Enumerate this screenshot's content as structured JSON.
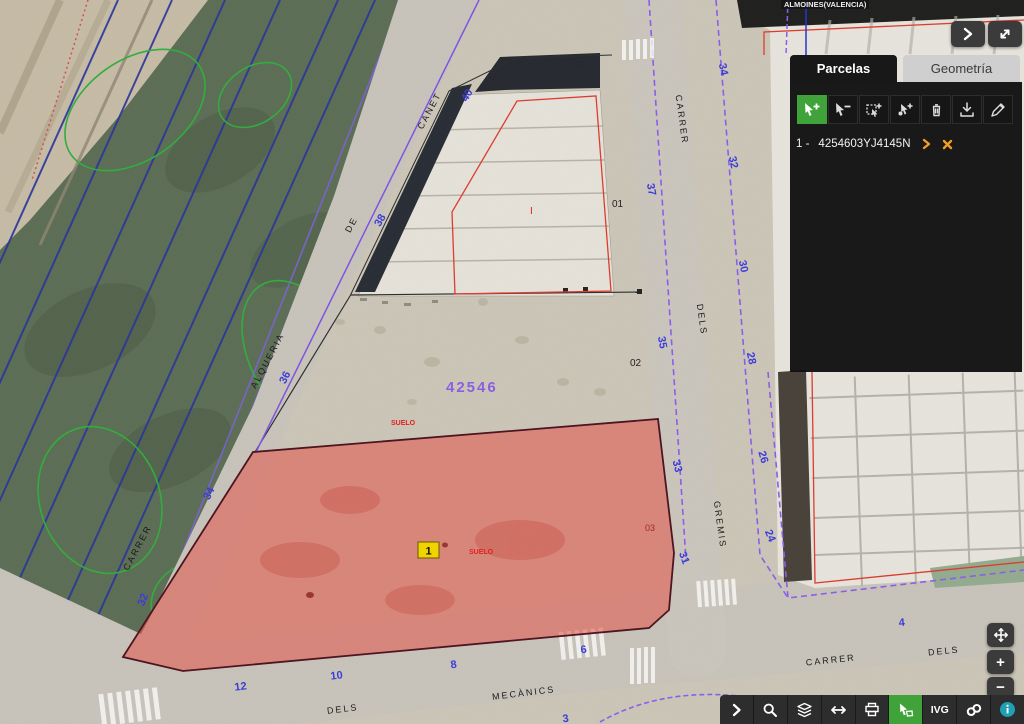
{
  "map": {
    "municipality_label": "ALMOINES(VALENCIA)",
    "block_number": "42546",
    "soil_labels": [
      {
        "text": "SUELO"
      },
      {
        "text": "SUELO"
      }
    ],
    "sub_parcel_labels": [
      {
        "text": "01"
      },
      {
        "text": "02"
      },
      {
        "text": "03"
      },
      {
        "text": "I"
      }
    ],
    "selected_parcel_marker": "1",
    "street_labels": [
      {
        "text": "CANET"
      },
      {
        "text": "DE"
      },
      {
        "text": "ALQUERIA"
      },
      {
        "text": "CARRER"
      },
      {
        "text": "CARRER"
      },
      {
        "text": "DELS"
      },
      {
        "text": "GREMIS"
      },
      {
        "text": "DELS"
      },
      {
        "text": "MECÀNICS"
      },
      {
        "text": "CARRER"
      },
      {
        "text": "DELS"
      }
    ],
    "house_numbers": [
      {
        "text": "40"
      },
      {
        "text": "38"
      },
      {
        "text": "36"
      },
      {
        "text": "34"
      },
      {
        "text": "32"
      },
      {
        "text": "37"
      },
      {
        "text": "35"
      },
      {
        "text": "33"
      },
      {
        "text": "31"
      },
      {
        "text": "34"
      },
      {
        "text": "32"
      },
      {
        "text": "30"
      },
      {
        "text": "28"
      },
      {
        "text": "26"
      },
      {
        "text": "24"
      },
      {
        "text": "12"
      },
      {
        "text": "10"
      },
      {
        "text": "8"
      },
      {
        "text": "6"
      },
      {
        "text": "3"
      },
      {
        "text": "4"
      }
    ],
    "colors": {
      "selected_parcel_fill": "#e4574b",
      "house_number_blue": "#3c3cd8",
      "boundary_purple": "#8a5cf0",
      "block_number_purple": "#8a5fe3",
      "outline_red": "#e0392c",
      "marker_yellow": "#f0d400"
    }
  },
  "panel": {
    "tabs": [
      {
        "label": "Parcelas",
        "active": true
      },
      {
        "label": "Geometría",
        "active": false
      }
    ],
    "tools": [
      {
        "name": "add-parcel-select"
      },
      {
        "name": "remove-parcel-select"
      },
      {
        "name": "rectangle-select"
      },
      {
        "name": "point-select"
      },
      {
        "name": "clear-selection"
      },
      {
        "name": "download-selection"
      },
      {
        "name": "edit-geometry"
      }
    ],
    "parcel_list": [
      {
        "index_label": "1 -",
        "reference": "4254603YJ4145N"
      }
    ]
  },
  "top_buttons": [
    {
      "name": "collapse-panel"
    },
    {
      "name": "fullscreen"
    }
  ],
  "zoom_controls": [
    {
      "name": "pan"
    },
    {
      "name": "zoom-in",
      "glyph": "+"
    },
    {
      "name": "zoom-out",
      "glyph": "−"
    }
  ],
  "bottom_toolbar": {
    "items": [
      {
        "name": "expand"
      },
      {
        "name": "search"
      },
      {
        "name": "layers"
      },
      {
        "name": "measure"
      },
      {
        "name": "print"
      },
      {
        "name": "select-parcels",
        "active": true
      },
      {
        "name": "ivg",
        "label": "IVG"
      },
      {
        "name": "cartography"
      },
      {
        "name": "info"
      }
    ]
  }
}
